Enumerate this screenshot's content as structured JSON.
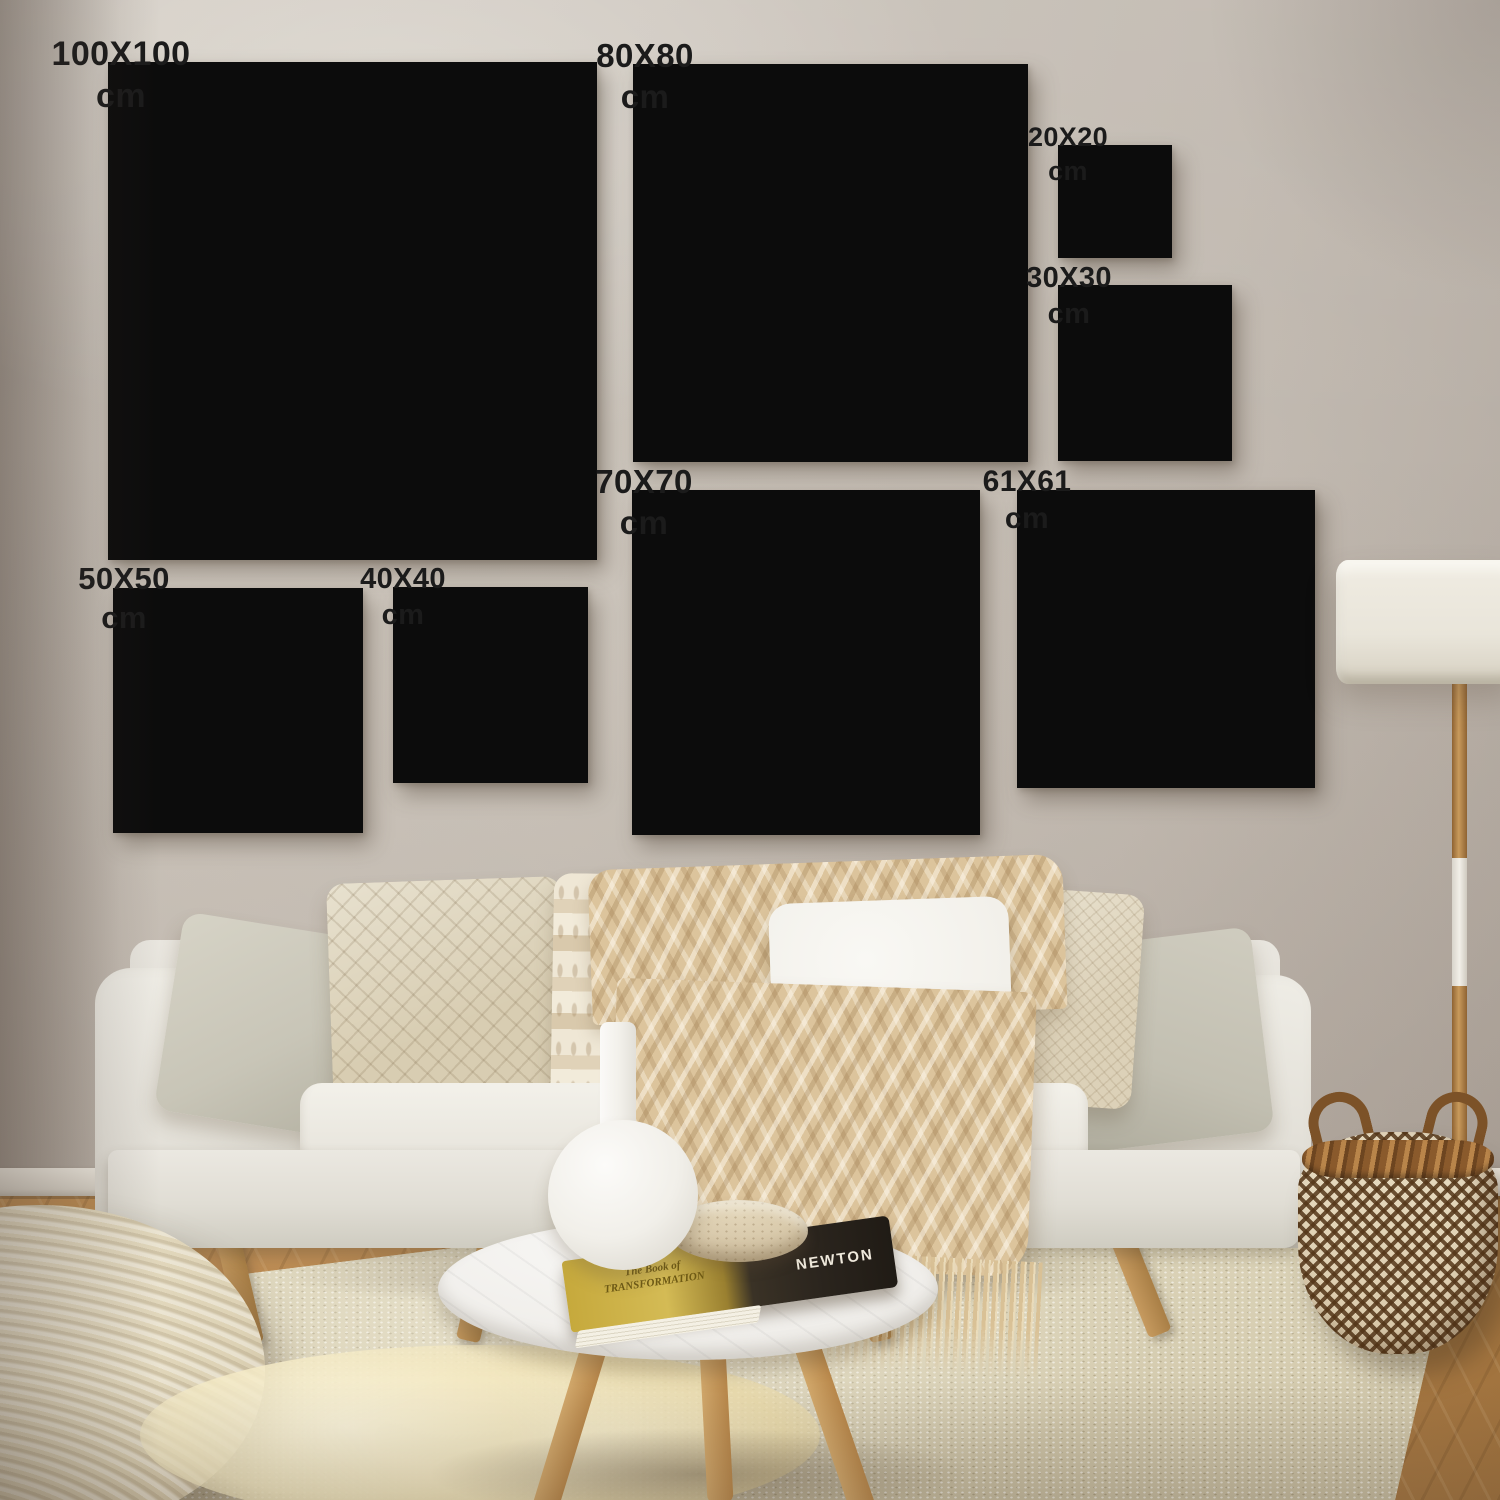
{
  "frames": [
    {
      "id": "100x100",
      "label": "100X100 cm"
    },
    {
      "id": "80x80",
      "label": "80X80 cm"
    },
    {
      "id": "20x20",
      "label": "20X20 cm"
    },
    {
      "id": "30x30",
      "label": "30X30 cm"
    },
    {
      "id": "50x50",
      "label": "50X50 cm"
    },
    {
      "id": "40x40",
      "label": "40X40 cm"
    },
    {
      "id": "70x70",
      "label": "70X70 cm"
    },
    {
      "id": "61x61",
      "label": "61X61 cm"
    }
  ],
  "book": {
    "cover_text": "The Book of TRANSFORMATION",
    "spine_title": "NEWTON"
  },
  "palette": {
    "frame_border": "#0c0c0c",
    "frame_canvas": "#f2eee3",
    "label_text": "#1b1b1b",
    "wall": "#c7bfb6",
    "wood_floor": "#b5854f",
    "rug": "#ddd4bb",
    "sofa": "#e9e6df",
    "throw": "#dcc49c",
    "basket_brown": "#8a5a2c",
    "lamp_shade": "#e9e5da",
    "table_top": "#f3f2ef",
    "book_gold": "#c6a93c",
    "book_dark": "#2a241d",
    "vase": "#f1efe9"
  }
}
